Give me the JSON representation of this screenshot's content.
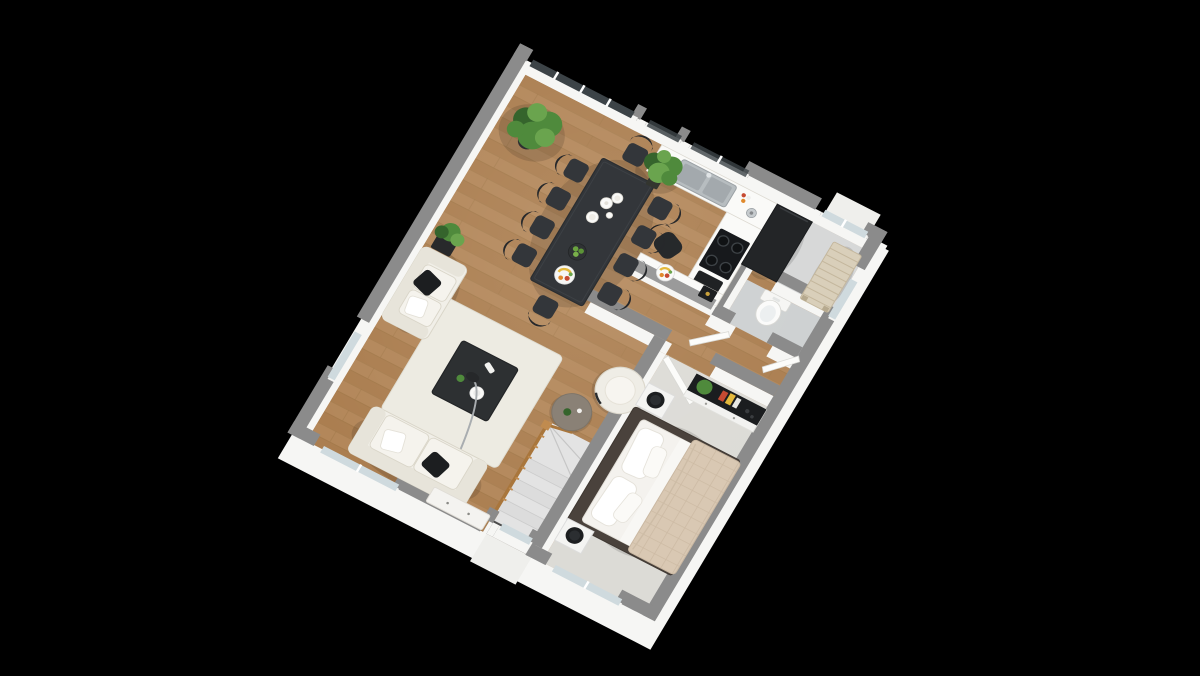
{
  "scene": {
    "description": "3D isometric floor plan rendering of a one-bedroom home with open living and dining room, kitchen, WC, entry hall, bedroom and a staircase, viewed from above on a black background",
    "background": "#000000",
    "style": "cut-away dollhouse render, walls capped in gray, oak plank flooring in living areas, gray floors in entry, WC and bedroom"
  },
  "palette": {
    "background": "#000000",
    "wood": "#b3875a",
    "woodLine": "#9e7647",
    "woodDark": "#ab7e50",
    "wallTop": "#8b8b8b",
    "wallTopDark": "#7e7e7e",
    "wallTopLight": "#9a9a9a",
    "wallFace": "#f6f6f4",
    "entryFloor": "#d6d7d7",
    "wcFloor": "#cdd0d1",
    "bedroomFloor": "#dcdbd6",
    "stairTread": "#e3e3e3",
    "stairTreadAlt": "#dcdcdc",
    "stairVoid": "#4c4c4c",
    "glassPale": "#cfdade",
    "glassDark": "#3c4347",
    "frameWhite": "#ffffff",
    "darkFurniture": "#33363a",
    "darkerFurniture": "#26282b",
    "darkest": "#1c1e20",
    "sofa": "#f1efe8",
    "sofaShade": "#e7e4da",
    "sofaLine": "#d9d5c8",
    "rug": "#edebe2",
    "railWood": "#c08b4f",
    "railWoodDark": "#a9763c",
    "quilt": "#d9c8b3",
    "quiltLine": "#c9b7a0",
    "bedFrame": "#4a423c",
    "bench": "#d9cfba",
    "benchLine": "#c4b79d",
    "steel": "#b7bdc0",
    "steelDark": "#9aa0a4",
    "white": "#f6f6f4",
    "porch": "#efefec",
    "plant": "#4f8a3c",
    "plantDark": "#35642c",
    "plantLight": "#6aa44e",
    "accentRed": "#c64a32",
    "accentYellow": "#e4b93c",
    "accentOrange": "#e08a2d",
    "accentGold": "#c9a13b"
  },
  "rooms": [
    {
      "name": "living-dining-room",
      "floor": "oak planks"
    },
    {
      "name": "kitchen",
      "floor": "oak planks"
    },
    {
      "name": "wc",
      "floor": "gray"
    },
    {
      "name": "entry-hall",
      "floor": "light gray"
    },
    {
      "name": "bedroom",
      "floor": "pale gray"
    },
    {
      "name": "staircase",
      "floor": "gray treads with wood railing"
    }
  ],
  "furniture_counts": {
    "dining_chairs": 10,
    "sofas": 2,
    "armchairs": 1,
    "nightstands": 2,
    "stools_black": 2,
    "plants": 5
  },
  "labels": {
    "floor_plan": "floor plan render",
    "dining_table": "dark dining table with tableware and fruit bowls",
    "dining_chairs": "ten dark dining chairs",
    "kitchen_counter": "white kitchen counter with double stainless sink",
    "cooktop": "black four-zone cooktop",
    "fridge": "tall dark refrigerator",
    "peninsula": "kitchen peninsula with fruit plate and coffee machine",
    "desk_chair": "dark upholstered chair",
    "toilet": "toilet in WC",
    "entry_bench": "slatted wooden entry bench",
    "loveseat": "white loveseat with black cushion",
    "large_sofa": "white three-seat sofa with black cushion",
    "coffee_table": "dark square coffee table on white rug",
    "armchair": "round white armchair",
    "side_table": "round gray side table",
    "floor_lamp": "arc floor lamp",
    "stairs": "staircase with wooden balustrade",
    "bed": "double bed with white pillows and beige plaid quilt",
    "dresser": "white dresser with dark top, plant and books",
    "sliding_door": "glazed sliding door",
    "windows": "white-silled windows",
    "plants": "green potted plants"
  }
}
